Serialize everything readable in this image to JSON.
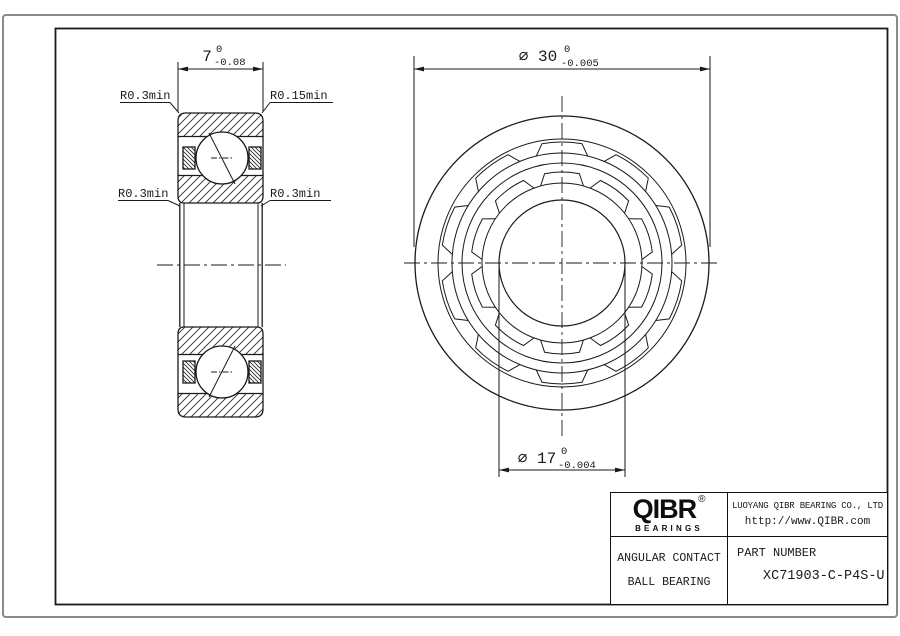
{
  "colors": {
    "line": "#1a1a1a",
    "outer_border": "#8a8a8a",
    "background": "#ffffff"
  },
  "dimensions": {
    "width": {
      "value": "7",
      "tol_upper": "0",
      "tol_lower": "-0.08"
    },
    "outer_diameter": {
      "value": "⌀ 30",
      "tol_upper": "0",
      "tol_lower": "-0.005"
    },
    "bore_diameter": {
      "value": "⌀ 17",
      "tol_upper": "0",
      "tol_lower": "-0.004"
    }
  },
  "annotations": {
    "r_top_left": "R0.3min",
    "r_top_right": "R0.15min",
    "r_mid_left": "R0.3min",
    "r_mid_right": "R0.3min"
  },
  "title_block": {
    "brand": "QIBR",
    "brand_sub": "BEARINGS",
    "registered_mark": "®",
    "company_name": "LUOYANG QIBR BEARING CO., LTD",
    "company_url": "http://www.QIBR.com",
    "product_line1": "ANGULAR CONTACT",
    "product_line2": "BALL BEARING",
    "part_label": "PART NUMBER",
    "part_number": "XC71903-C-P4S-U"
  }
}
